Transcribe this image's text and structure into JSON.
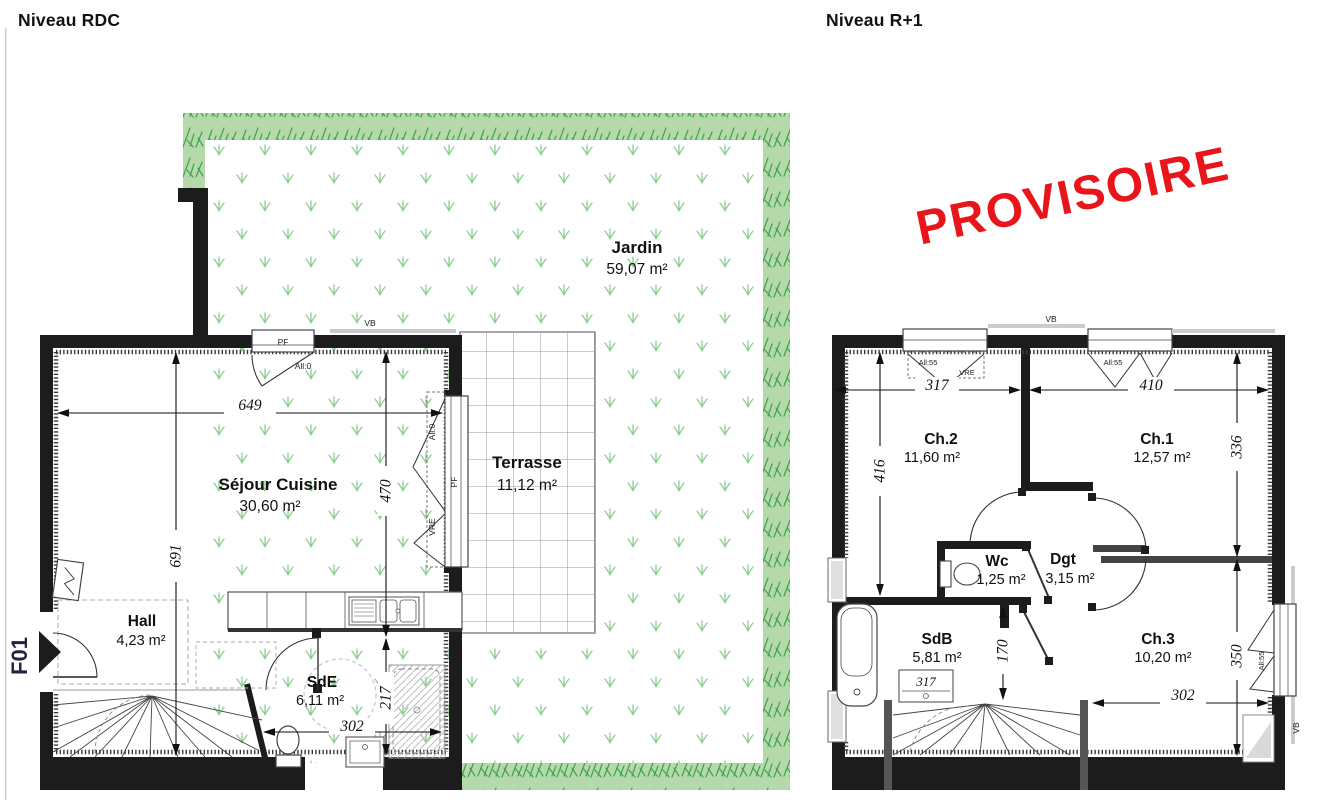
{
  "unit_label": "F01",
  "stamp": {
    "text": "PROVISOIRE",
    "color": "#e8161b"
  },
  "plans": {
    "rdc": {
      "title": "Niveau RDC",
      "rooms": {
        "jardin": {
          "name": "Jardin",
          "area": "59,07 m²"
        },
        "terrasse": {
          "name": "Terrasse",
          "area": "11,12 m²"
        },
        "sejour": {
          "name": "Séjour Cuisine",
          "area": "30,60 m²"
        },
        "hall": {
          "name": "Hall",
          "area": "4,23 m²"
        },
        "sde": {
          "name": "SdE",
          "area": "6,11 m²"
        }
      },
      "dims": {
        "total_width": "649",
        "left_height": "691",
        "right_height": "470",
        "sde_width": "302",
        "sde_height": "217"
      },
      "annotations": {
        "pf_top": "PF",
        "all0_top": "All:0",
        "vb_top": "VB",
        "pf_right": "PF",
        "all0_right": "All:0",
        "vre_right": "VRE"
      }
    },
    "r1": {
      "title": "Niveau R+1",
      "rooms": {
        "ch2": {
          "name": "Ch.2",
          "area": "11,60 m²"
        },
        "ch1": {
          "name": "Ch.1",
          "area": "12,57 m²"
        },
        "wc": {
          "name": "Wc",
          "area": "1,25 m²"
        },
        "dgt": {
          "name": "Dgt",
          "area": "3,15 m²"
        },
        "sdb": {
          "name": "SdB",
          "area": "5,81 m²"
        },
        "ch3": {
          "name": "Ch.3",
          "area": "10,20 m²"
        }
      },
      "dims": {
        "ch2_width": "317",
        "ch1_width": "410",
        "ch2_height": "416",
        "ch1_height": "336",
        "ch3_height": "350",
        "ch3_width": "302",
        "sdb_height": "170",
        "sdb_sink_width": "317"
      },
      "annotations": {
        "vb_top": "VB",
        "all55_ch2": "All:55",
        "vre_ch2": "VRE",
        "all55_ch1": "All:55",
        "all55_right": "All:55",
        "vb_right": "VB"
      }
    }
  },
  "colors": {
    "wall": "#1c1c1c",
    "garden_band": "#b5d9aa",
    "garden_tuft": "#3fa34d",
    "grass_symbol": "#8ccf8f",
    "stamp_red": "#e8161b"
  }
}
